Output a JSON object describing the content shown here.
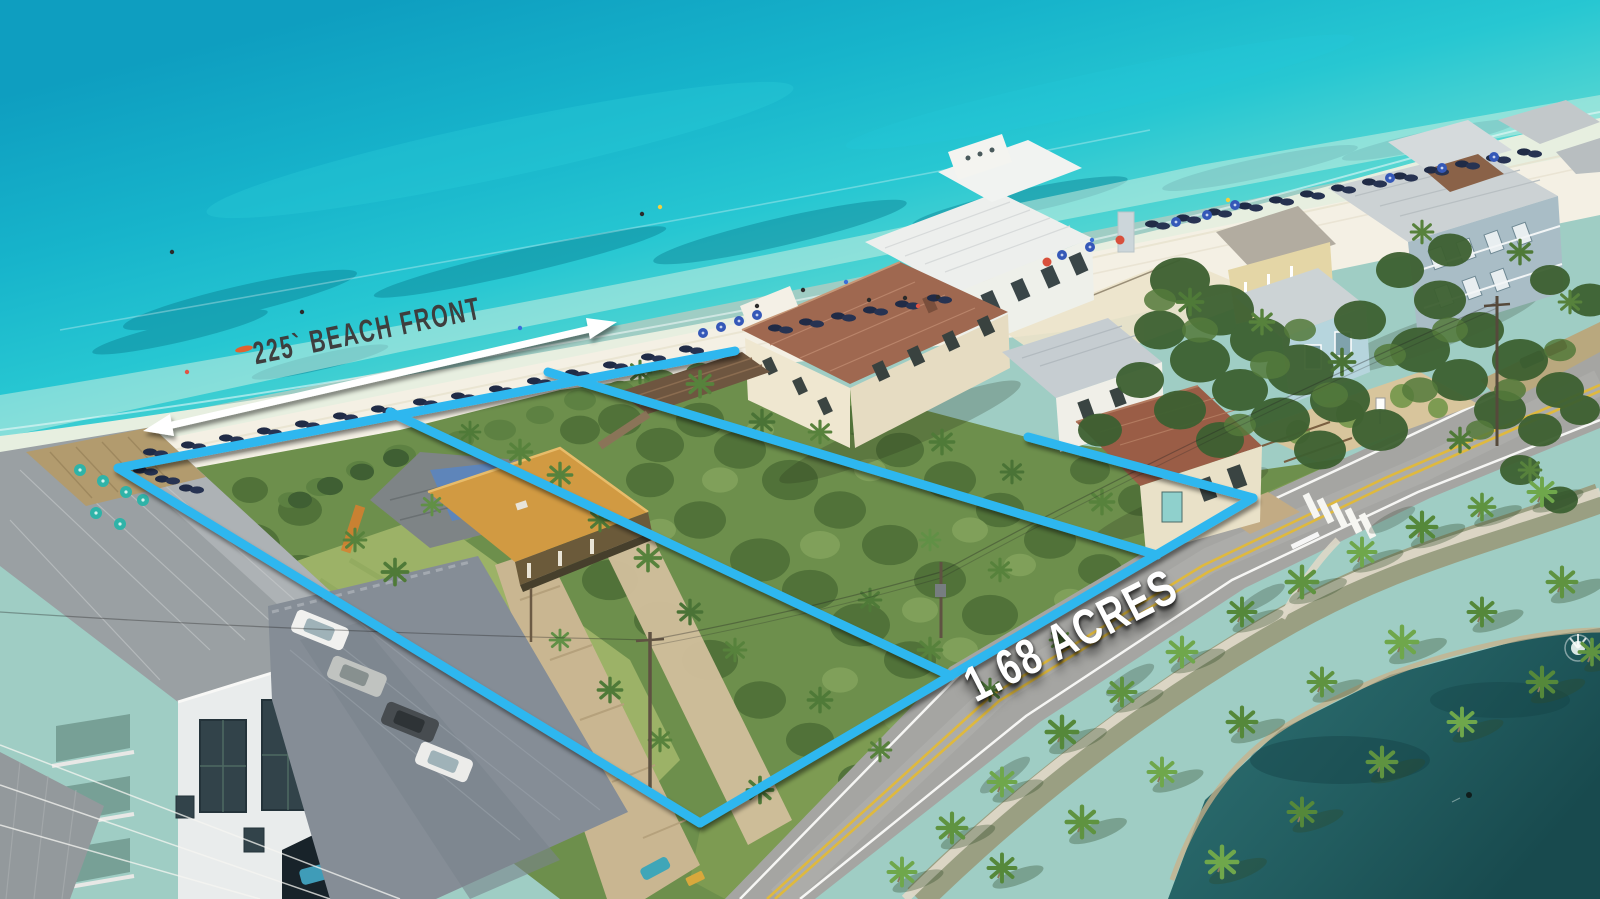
{
  "annotations": {
    "beach_front_label": "225` BEACH FRONT",
    "acreage_label": "1.68 ACRES",
    "overlay_line_color": "#2eb7ef",
    "arrow_color": "#ffffff",
    "beach_front_text_color": "#3e3e3e",
    "acreage_text_color": "#ffffff"
  }
}
